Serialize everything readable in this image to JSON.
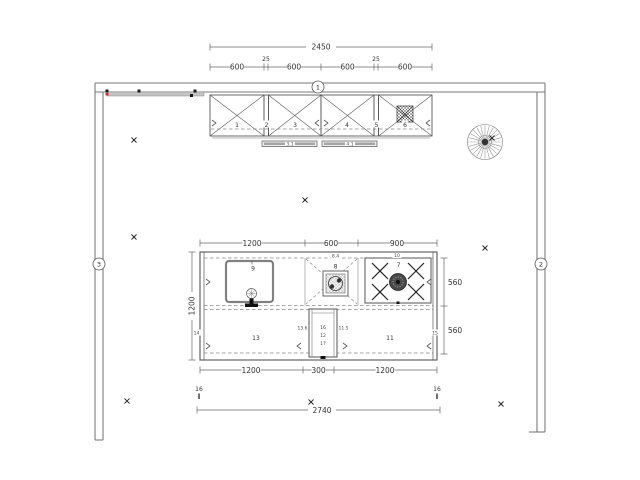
{
  "plan": {
    "wall_tags": {
      "top": "1",
      "right": "2",
      "left": "3"
    },
    "upper_total": "2450",
    "upper_segments": [
      "600",
      "25",
      "600",
      "600",
      "25",
      "600"
    ],
    "cabinets": {
      "c1": "1",
      "c2": "2",
      "c3": "3",
      "c4": "4",
      "c5": "5",
      "c6": "6"
    },
    "lights": [
      "3.1",
      "4.1"
    ],
    "island": {
      "top_dims": [
        "1200",
        "600",
        "900"
      ],
      "bottom_dims": [
        "1200",
        "300",
        "1200"
      ],
      "left_dim": "1200",
      "right_dims": [
        "560",
        "560"
      ],
      "overall_dim": "2740",
      "edge_dims": [
        "16",
        "16"
      ],
      "sink_unit": "9",
      "prep_unit": "8",
      "prep_tag": "8.4",
      "cooktop_unit": "7",
      "cooktop_tag": "10",
      "base_left": "13",
      "base_right": "11",
      "panel_left": "14",
      "panel_right": "15",
      "tall_unit_top": "16",
      "tall_unit_mid": "12",
      "tall_unit_bottom": "17",
      "tall_tag_left": "13.6",
      "tall_tag_right": "11.5"
    }
  }
}
